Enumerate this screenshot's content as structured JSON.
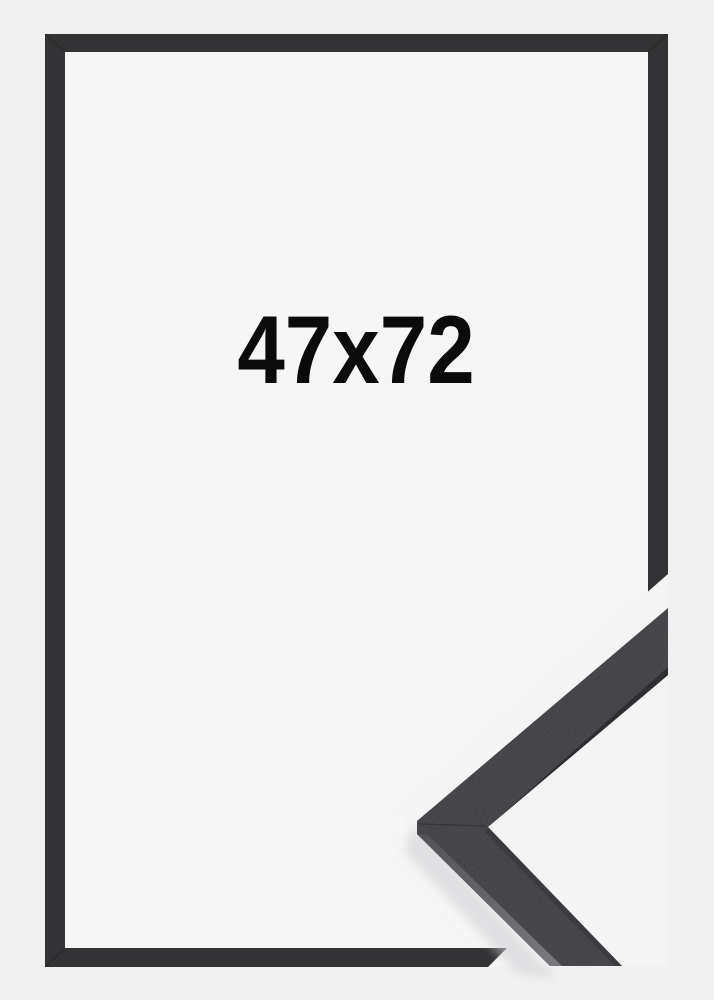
{
  "product": {
    "size_label": "47x72"
  },
  "colors": {
    "background": "#f0f0f1",
    "photo_background": "#f4f4f5",
    "frame_opening": "#f6f6f7",
    "frame": "#333335",
    "label_text": "#0b0b0b",
    "detail_face": "#38383c",
    "detail_edge_dark": "#1e1e22",
    "detail_edge_light_start": "#45454a",
    "detail_edge_light_end": "#6e6e73",
    "detail_shadow": "#cfcfd2"
  }
}
